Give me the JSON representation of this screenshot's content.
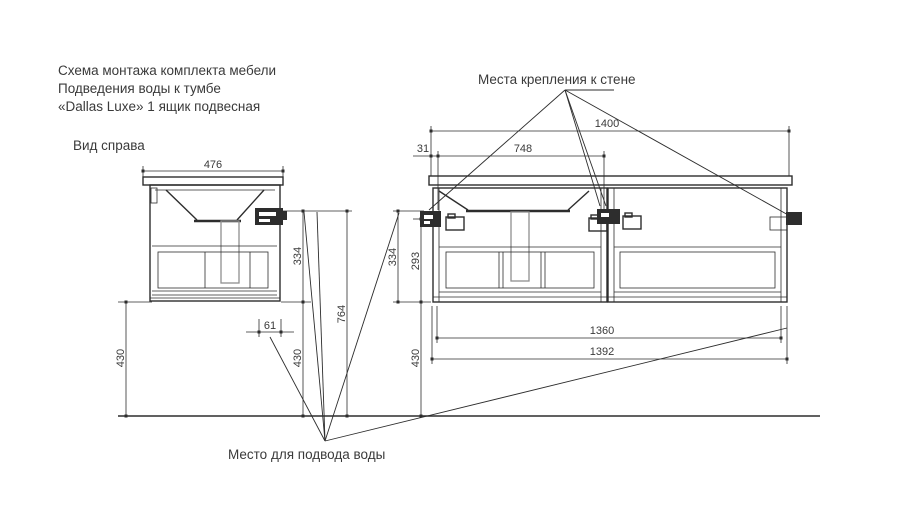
{
  "title": {
    "line1": "Схема монтажа комплекта мебели",
    "line2": "Подведения воды к тумбе",
    "line3": "«Dallas Luxe» 1 ящик подвесная"
  },
  "side_view": {
    "label": "Вид справа",
    "dims": {
      "width": "476",
      "mount_to_cabinet_bottom": "334",
      "mount_to_floor": "764",
      "water_offset": "61",
      "cabinet_bottom_to_floor": "430",
      "water_height": "430"
    }
  },
  "front_view": {
    "dims": {
      "countertop_width": "1400",
      "mount_span": "748",
      "edge_to_mount": "31",
      "top_to_cabinet_bottom": "334",
      "mount_to_cabinet_bottom": "293",
      "cabinet_bottom_to_floor": "430",
      "inner_width": "1360",
      "outer_width": "1392"
    }
  },
  "annotations": {
    "wall_mount_label": "Места крепления к стене",
    "water_supply_label": "Место для подвода воды"
  },
  "colors": {
    "line": "#2d2d2d",
    "text": "#3a3a3a",
    "hidden": "#8f8f8f",
    "background": "#ffffff"
  }
}
